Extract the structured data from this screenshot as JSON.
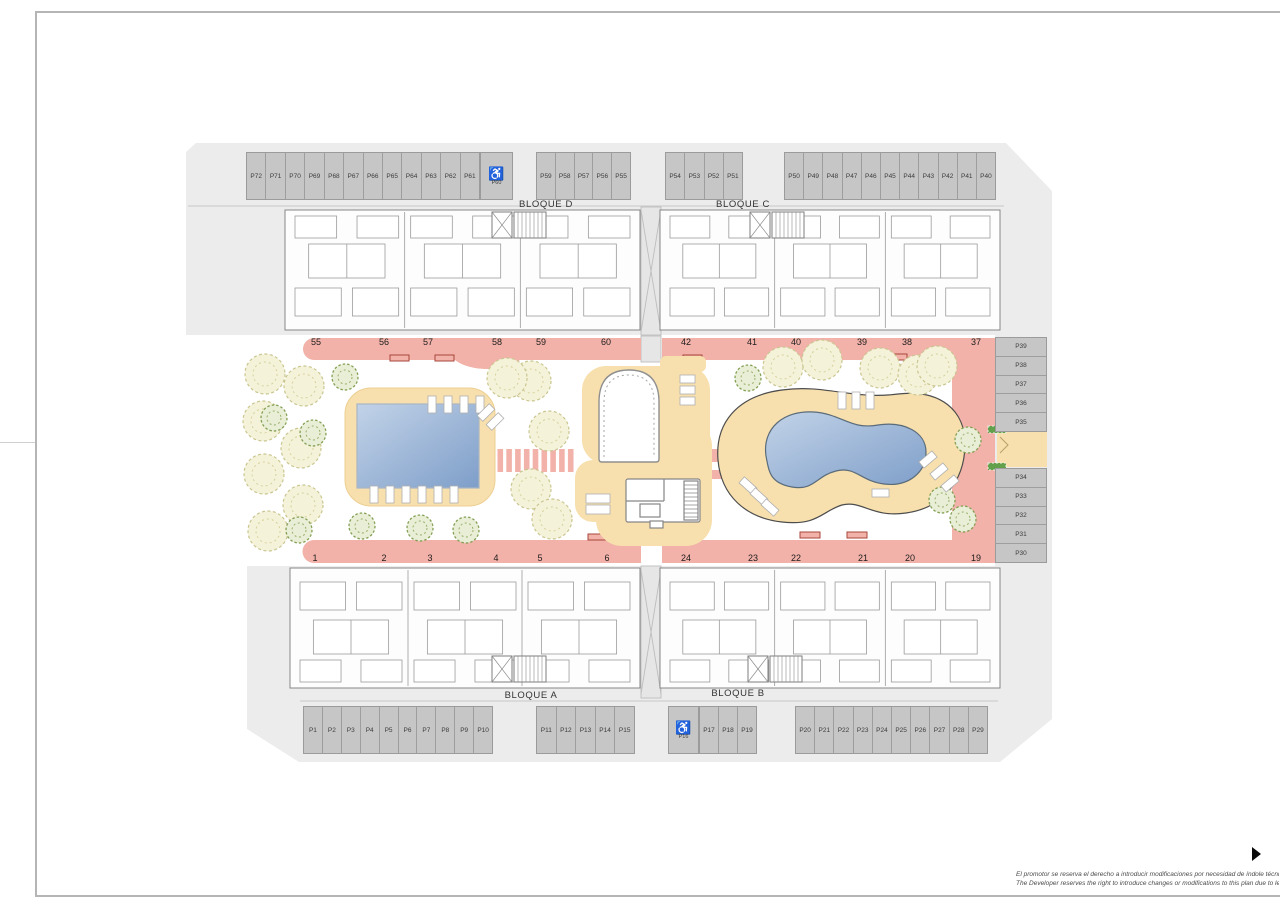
{
  "sheet": {
    "disclaimer_line1": "El promotor se reserva el derecho a introducir modificaciones por necesidad de índole técnica o legal.",
    "disclaimer_line2": "The Developer reserves the right to introduce changes or modifications to this plan due to legal or tech"
  },
  "blocks": [
    {
      "id": "bloque-d",
      "label": "BLOQUE D"
    },
    {
      "id": "bloque-c",
      "label": "BLOQUE C"
    },
    {
      "id": "bloque-a",
      "label": "BLOQUE A"
    },
    {
      "id": "bloque-b",
      "label": "BLOQUE B"
    }
  ],
  "units": {
    "north_row": [
      "55",
      "56",
      "57",
      "58",
      "59",
      "60",
      "42",
      "41",
      "40",
      "39",
      "38",
      "37"
    ],
    "south_row": [
      "1",
      "2",
      "3",
      "4",
      "5",
      "6",
      "24",
      "23",
      "22",
      "21",
      "20",
      "19"
    ]
  },
  "parking": {
    "accessible_icon": "♿",
    "groups": [
      {
        "id": "north-west",
        "accessible": false,
        "labels": [
          "P72",
          "P71",
          "P70",
          "P69",
          "P68",
          "P67",
          "P66",
          "P65",
          "P64",
          "P63",
          "P62",
          "P61"
        ]
      },
      {
        "id": "north-west-accessible",
        "accessible": true,
        "labels": [
          "P60"
        ]
      },
      {
        "id": "north-mid",
        "accessible": false,
        "labels": [
          "P59",
          "P58",
          "P57",
          "P56",
          "P55"
        ]
      },
      {
        "id": "north-east-small",
        "accessible": false,
        "labels": [
          "P54",
          "P53",
          "P52",
          "P51"
        ]
      },
      {
        "id": "north-east",
        "accessible": false,
        "labels": [
          "P50",
          "P49",
          "P48",
          "P47",
          "P46",
          "P45",
          "P44",
          "P43",
          "P42",
          "P41",
          "P40"
        ]
      },
      {
        "id": "east-upper",
        "accessible": false,
        "labels": [
          "P39",
          "P38",
          "P37",
          "P36",
          "P35"
        ]
      },
      {
        "id": "east-lower",
        "accessible": false,
        "labels": [
          "P34",
          "P33",
          "P32",
          "P31",
          "P30"
        ]
      },
      {
        "id": "south-west",
        "accessible": false,
        "labels": [
          "P1",
          "P2",
          "P3",
          "P4",
          "P5",
          "P6",
          "P7",
          "P8",
          "P9",
          "P10"
        ]
      },
      {
        "id": "south-mid",
        "accessible": false,
        "labels": [
          "P11",
          "P12",
          "P13",
          "P14",
          "P15"
        ]
      },
      {
        "id": "south-accessible",
        "accessible": true,
        "labels": [
          "P16"
        ]
      },
      {
        "id": "south-small",
        "accessible": false,
        "labels": [
          "P17",
          "P18",
          "P19"
        ]
      },
      {
        "id": "south-east",
        "accessible": false,
        "labels": [
          "P20",
          "P21",
          "P22",
          "P23",
          "P24",
          "P25",
          "P26",
          "P27",
          "P28",
          "P29"
        ]
      }
    ]
  },
  "colors": {
    "walkway_pink": "#f2b2a9",
    "deck_tan": "#f7e0ad",
    "pool_blue_light": "#bdd0e8",
    "pool_blue_dark": "#7e9ec9",
    "parking_gray": "#c6c6c6",
    "site_gray": "#ececec"
  }
}
